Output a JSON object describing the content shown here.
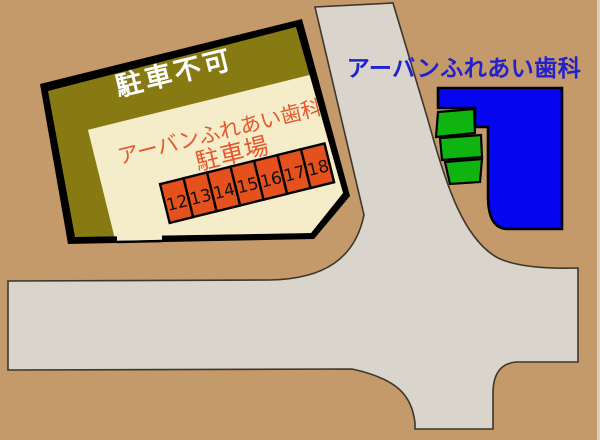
{
  "colors": {
    "background": "#c59a6a",
    "road": "#d9d4cc",
    "road_outline": "#3d362b",
    "lot_border": "#000000",
    "no_parking_band": "#877a12",
    "lot_surface": "#f5ecc9",
    "space_fill": "#e5511d",
    "space_number": "#111111",
    "lot_text": "#e4582b",
    "band_text": "#ffffff",
    "building": "#0505f0",
    "building_text": "#2222cc",
    "green_space": "#10b410"
  },
  "parking_lot": {
    "no_parking_label": "駐車不可",
    "name_line1": "アーバンふれあい歯科",
    "name_line2": "駐車場",
    "spaces": [
      "12",
      "13",
      "14",
      "15",
      "16",
      "17",
      "18"
    ]
  },
  "clinic": {
    "label": "アーバンふれあい歯科"
  }
}
